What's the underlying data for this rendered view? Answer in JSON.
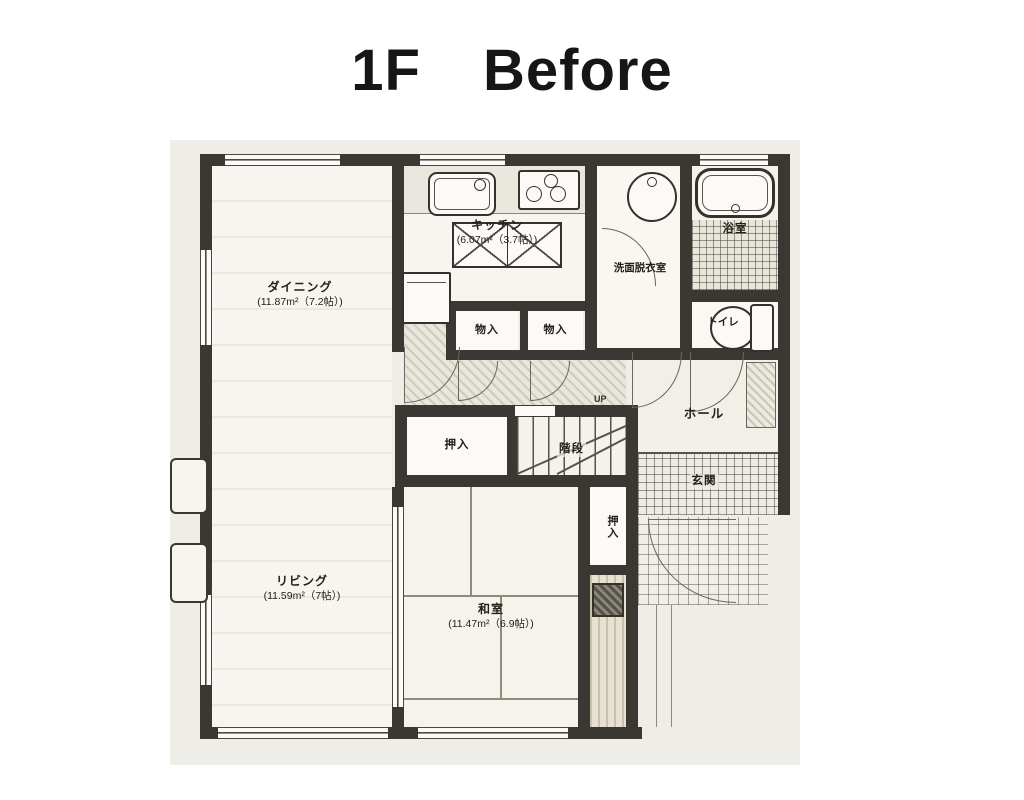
{
  "title": {
    "floor": "1F",
    "phase": "Before"
  },
  "rooms": {
    "dining": {
      "name": "ダイニング",
      "area": "(11.87m²（7.2帖）)"
    },
    "kitchen": {
      "name": "キッチン",
      "area": "(6.07m²（3.7帖）)"
    },
    "living": {
      "name": "リビング",
      "area": "(11.59m²（7帖）)"
    },
    "japanese_room": {
      "name": "和室",
      "area": "(11.47m²（6.9帖）)"
    },
    "washroom": {
      "name": "洗面脱衣室"
    },
    "bathroom": {
      "name": "浴室"
    },
    "toilet": {
      "name": "トイレ"
    },
    "storage_left": {
      "name": "物入"
    },
    "storage_right": {
      "name": "物入"
    },
    "closet_hall": {
      "name": "押入"
    },
    "closet_japanese": {
      "name": "押入"
    },
    "stairs": {
      "name": "階段",
      "direction": "UP"
    },
    "hall": {
      "name": "ホール"
    },
    "entrance": {
      "name": "玄関"
    }
  },
  "colors": {
    "wall": "#3b3833",
    "paper": "#efede7",
    "title_text": "#161616"
  }
}
